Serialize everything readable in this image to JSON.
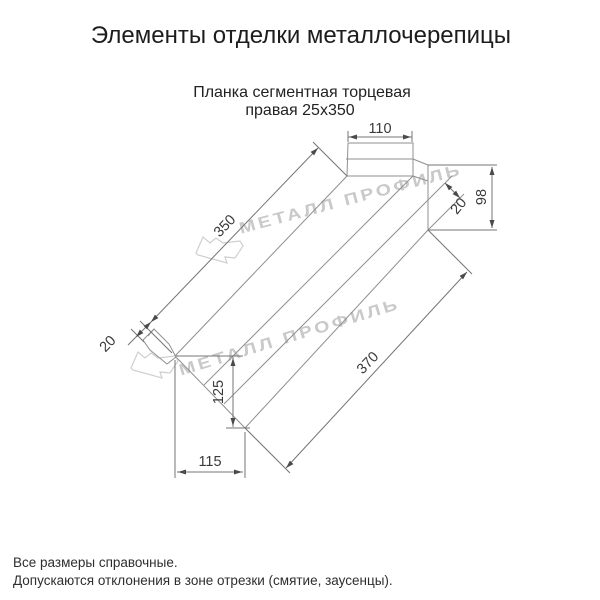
{
  "header": {
    "title": "Элементы отделки металлочерепицы",
    "subtitle_line1": "Планка сегментная торцевая",
    "subtitle_line2": "правая 25х350"
  },
  "drawing": {
    "name": "segmented-end-strip-right-isometric-view",
    "dimensions": {
      "top_face_width": "110",
      "flange_height": "98",
      "flange_fold": "20",
      "top_edge_length": "350",
      "end_hem_fold": "20",
      "bottom_edge_length": "370",
      "end_cut_drop": "125",
      "end_cut_run": "115"
    }
  },
  "watermark": {
    "text_upper": "МЕТАЛЛ ПРОФИЛЬ",
    "text_lower": "МЕТАЛЛ ПРОФИЛЬ",
    "logo_name": "metall-profil-logo",
    "color": "#c9c9c9"
  },
  "footer": {
    "line1": "Все размеры справочные.",
    "line2": "Допускаются отклонения в зоне отрезки (смятие, заусенцы)."
  },
  "colors": {
    "background": "#ffffff",
    "object_line": "#8f8f8f",
    "dimension_line": "#747474",
    "text": "#1d1d1d",
    "watermark": "#c9c9c9"
  }
}
